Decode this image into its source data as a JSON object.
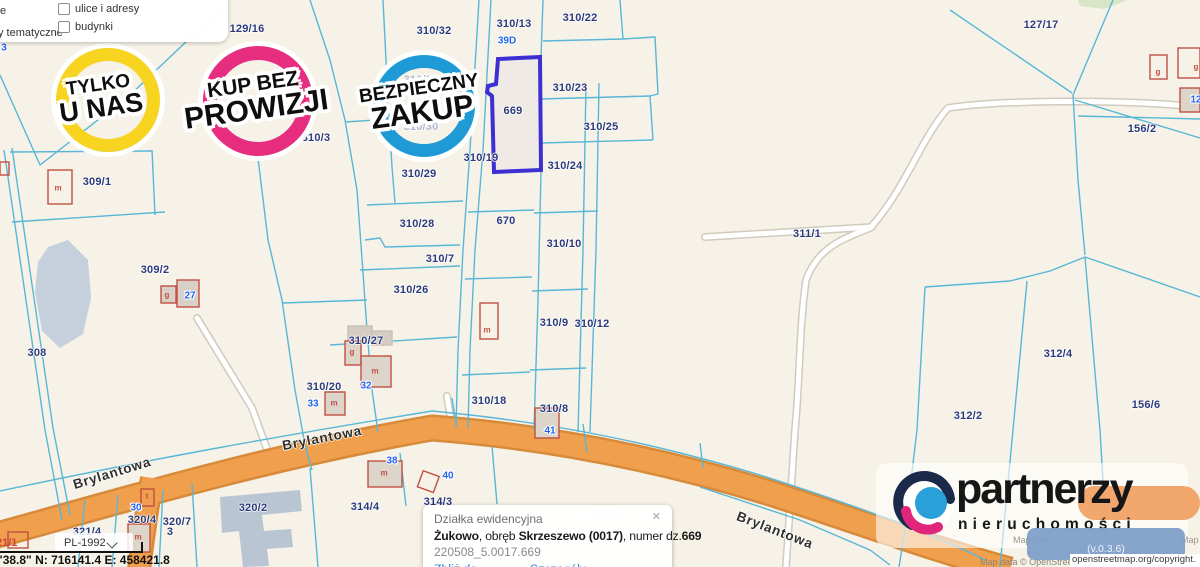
{
  "layers_panel": {
    "items": [
      {
        "label": "ulice i adresy"
      },
      {
        "label": "budynki"
      }
    ],
    "left_fragments": [
      "e",
      "y tematyczne"
    ]
  },
  "badges": [
    {
      "line1": "TYLKO",
      "line2": "U NAS",
      "color": "#f6d41f"
    },
    {
      "line1": "KUP BEZ",
      "line2": "PROWIZJI",
      "color": "#e62d80"
    },
    {
      "line1": "BEZPIECZNY",
      "line2": "ZAKUP",
      "color": "#1e9bd7"
    }
  ],
  "map": {
    "highlighted_parcel": "669",
    "line_color": "#58b7d6",
    "road_color": "#f09f4d",
    "highlight_color": "#3d2fd1",
    "parcel_labels": [
      {
        "t": "129/16",
        "x": 247,
        "y": 29
      },
      {
        "t": "310/32",
        "x": 434,
        "y": 31
      },
      {
        "t": "310/13",
        "x": 514,
        "y": 24
      },
      {
        "t": "310/22",
        "x": 580,
        "y": 18
      },
      {
        "t": "310/23",
        "x": 570,
        "y": 88
      },
      {
        "t": "310/25",
        "x": 601,
        "y": 127
      },
      {
        "t": "310/24",
        "x": 565,
        "y": 166
      },
      {
        "t": "669",
        "x": 513,
        "y": 111
      },
      {
        "t": "670",
        "x": 506,
        "y": 221
      },
      {
        "t": "310/10",
        "x": 564,
        "y": 244
      },
      {
        "t": "310/9",
        "x": 554,
        "y": 323
      },
      {
        "t": "310/12",
        "x": 592,
        "y": 324
      },
      {
        "t": "310/19",
        "x": 481,
        "y": 158
      },
      {
        "t": "310/29",
        "x": 419,
        "y": 174
      },
      {
        "t": "310/28",
        "x": 417,
        "y": 224
      },
      {
        "t": "310/7",
        "x": 440,
        "y": 259
      },
      {
        "t": "310/26",
        "x": 411,
        "y": 290
      },
      {
        "t": "310/27",
        "x": 366,
        "y": 341
      },
      {
        "t": "310/20",
        "x": 324,
        "y": 387
      },
      {
        "t": "310/18",
        "x": 489,
        "y": 401
      },
      {
        "t": "310/8",
        "x": 554,
        "y": 409
      },
      {
        "t": "310/3",
        "x": 316,
        "y": 138
      },
      {
        "t": "310/31",
        "x": 421,
        "y": 80,
        "v": "faded"
      },
      {
        "t": "310/30",
        "x": 421,
        "y": 127,
        "v": "faded"
      },
      {
        "t": "309/1",
        "x": 97,
        "y": 182
      },
      {
        "t": "309/2",
        "x": 155,
        "y": 270
      },
      {
        "t": "308",
        "x": 37,
        "y": 353
      },
      {
        "t": "311/1",
        "x": 807,
        "y": 234
      },
      {
        "t": "127/17",
        "x": 1041,
        "y": 25
      },
      {
        "t": "156/2",
        "x": 1142,
        "y": 129
      },
      {
        "t": "312/4",
        "x": 1058,
        "y": 354
      },
      {
        "t": "312/2",
        "x": 968,
        "y": 416
      },
      {
        "t": "156/6",
        "x": 1146,
        "y": 405
      },
      {
        "t": "321/4",
        "x": 87,
        "y": 532
      },
      {
        "t": "320/4",
        "x": 142,
        "y": 520
      },
      {
        "t": "320/7",
        "x": 177,
        "y": 522
      },
      {
        "t": "320/2",
        "x": 253,
        "y": 508
      },
      {
        "t": "314/4",
        "x": 365,
        "y": 507
      },
      {
        "t": "314/3",
        "x": 438,
        "y": 502
      },
      {
        "t": "315/2",
        "x": 604,
        "y": 515,
        "v": "ghost"
      },
      {
        "t": "3",
        "x": 170,
        "y": 532
      }
    ],
    "address_labels": [
      {
        "t": "39D",
        "x": 507,
        "y": 41
      },
      {
        "t": "27",
        "x": 190,
        "y": 296
      },
      {
        "t": "33",
        "x": 313,
        "y": 404
      },
      {
        "t": "32",
        "x": 366,
        "y": 386
      },
      {
        "t": "38",
        "x": 392,
        "y": 461
      },
      {
        "t": "40",
        "x": 448,
        "y": 476
      },
      {
        "t": "41",
        "x": 550,
        "y": 431
      },
      {
        "t": "30",
        "x": 136,
        "y": 508
      },
      {
        "t": "12",
        "x": 1196,
        "y": 100
      },
      {
        "t": "3",
        "x": 4,
        "y": 48
      }
    ],
    "building_letters": [
      {
        "t": "m",
        "x": 58,
        "y": 188
      },
      {
        "t": "g",
        "x": 167,
        "y": 295
      },
      {
        "t": "g",
        "x": 352,
        "y": 352
      },
      {
        "t": "m",
        "x": 375,
        "y": 371
      },
      {
        "t": "m",
        "x": 334,
        "y": 403
      },
      {
        "t": "m",
        "x": 487,
        "y": 330
      },
      {
        "t": "m",
        "x": 384,
        "y": 473
      },
      {
        "t": "m",
        "x": 138,
        "y": 537
      },
      {
        "t": "t",
        "x": 147,
        "y": 496
      },
      {
        "t": "g",
        "x": 1158,
        "y": 72
      },
      {
        "t": "g",
        "x": 1196,
        "y": 67
      }
    ],
    "road_labels": [
      {
        "t": "Brylantowa",
        "x": 112,
        "y": 473,
        "r": -17
      },
      {
        "t": "Brylantowa",
        "x": 322,
        "y": 438,
        "r": -11
      },
      {
        "t": "Brylantowa",
        "x": 775,
        "y": 530,
        "r": 21
      }
    ],
    "red_label": {
      "t": "21/1"
    }
  },
  "popup": {
    "title": "Działka ewidencyjna",
    "bold1": "Żukowo",
    "mid1": ", obręb ",
    "bold2": "Skrzeszewo (0017)",
    "mid2": ", numer dz.",
    "bold3": "669",
    "code": "220508_5.0017.669",
    "link1": "Zbliż do obiektu",
    "link2": "Szczegóły (I)",
    "link3": "Inne",
    "close": "✕",
    "plus": "+"
  },
  "controls": {
    "crs": "PL-1992",
    "coords": "\"38.8\"  N: 716141.4   E: 458421.8"
  },
  "logo": {
    "brand": "partnerzy",
    "sub": "nieruchomości",
    "version": "(v.0.3.6)"
  },
  "attribution": {
    "tiles_left": "Map tiles",
    "tiles_right": "Map",
    "data_line": "Map data © OpenStreetMap",
    "copyright": "openstreetmap.org/copyright."
  }
}
